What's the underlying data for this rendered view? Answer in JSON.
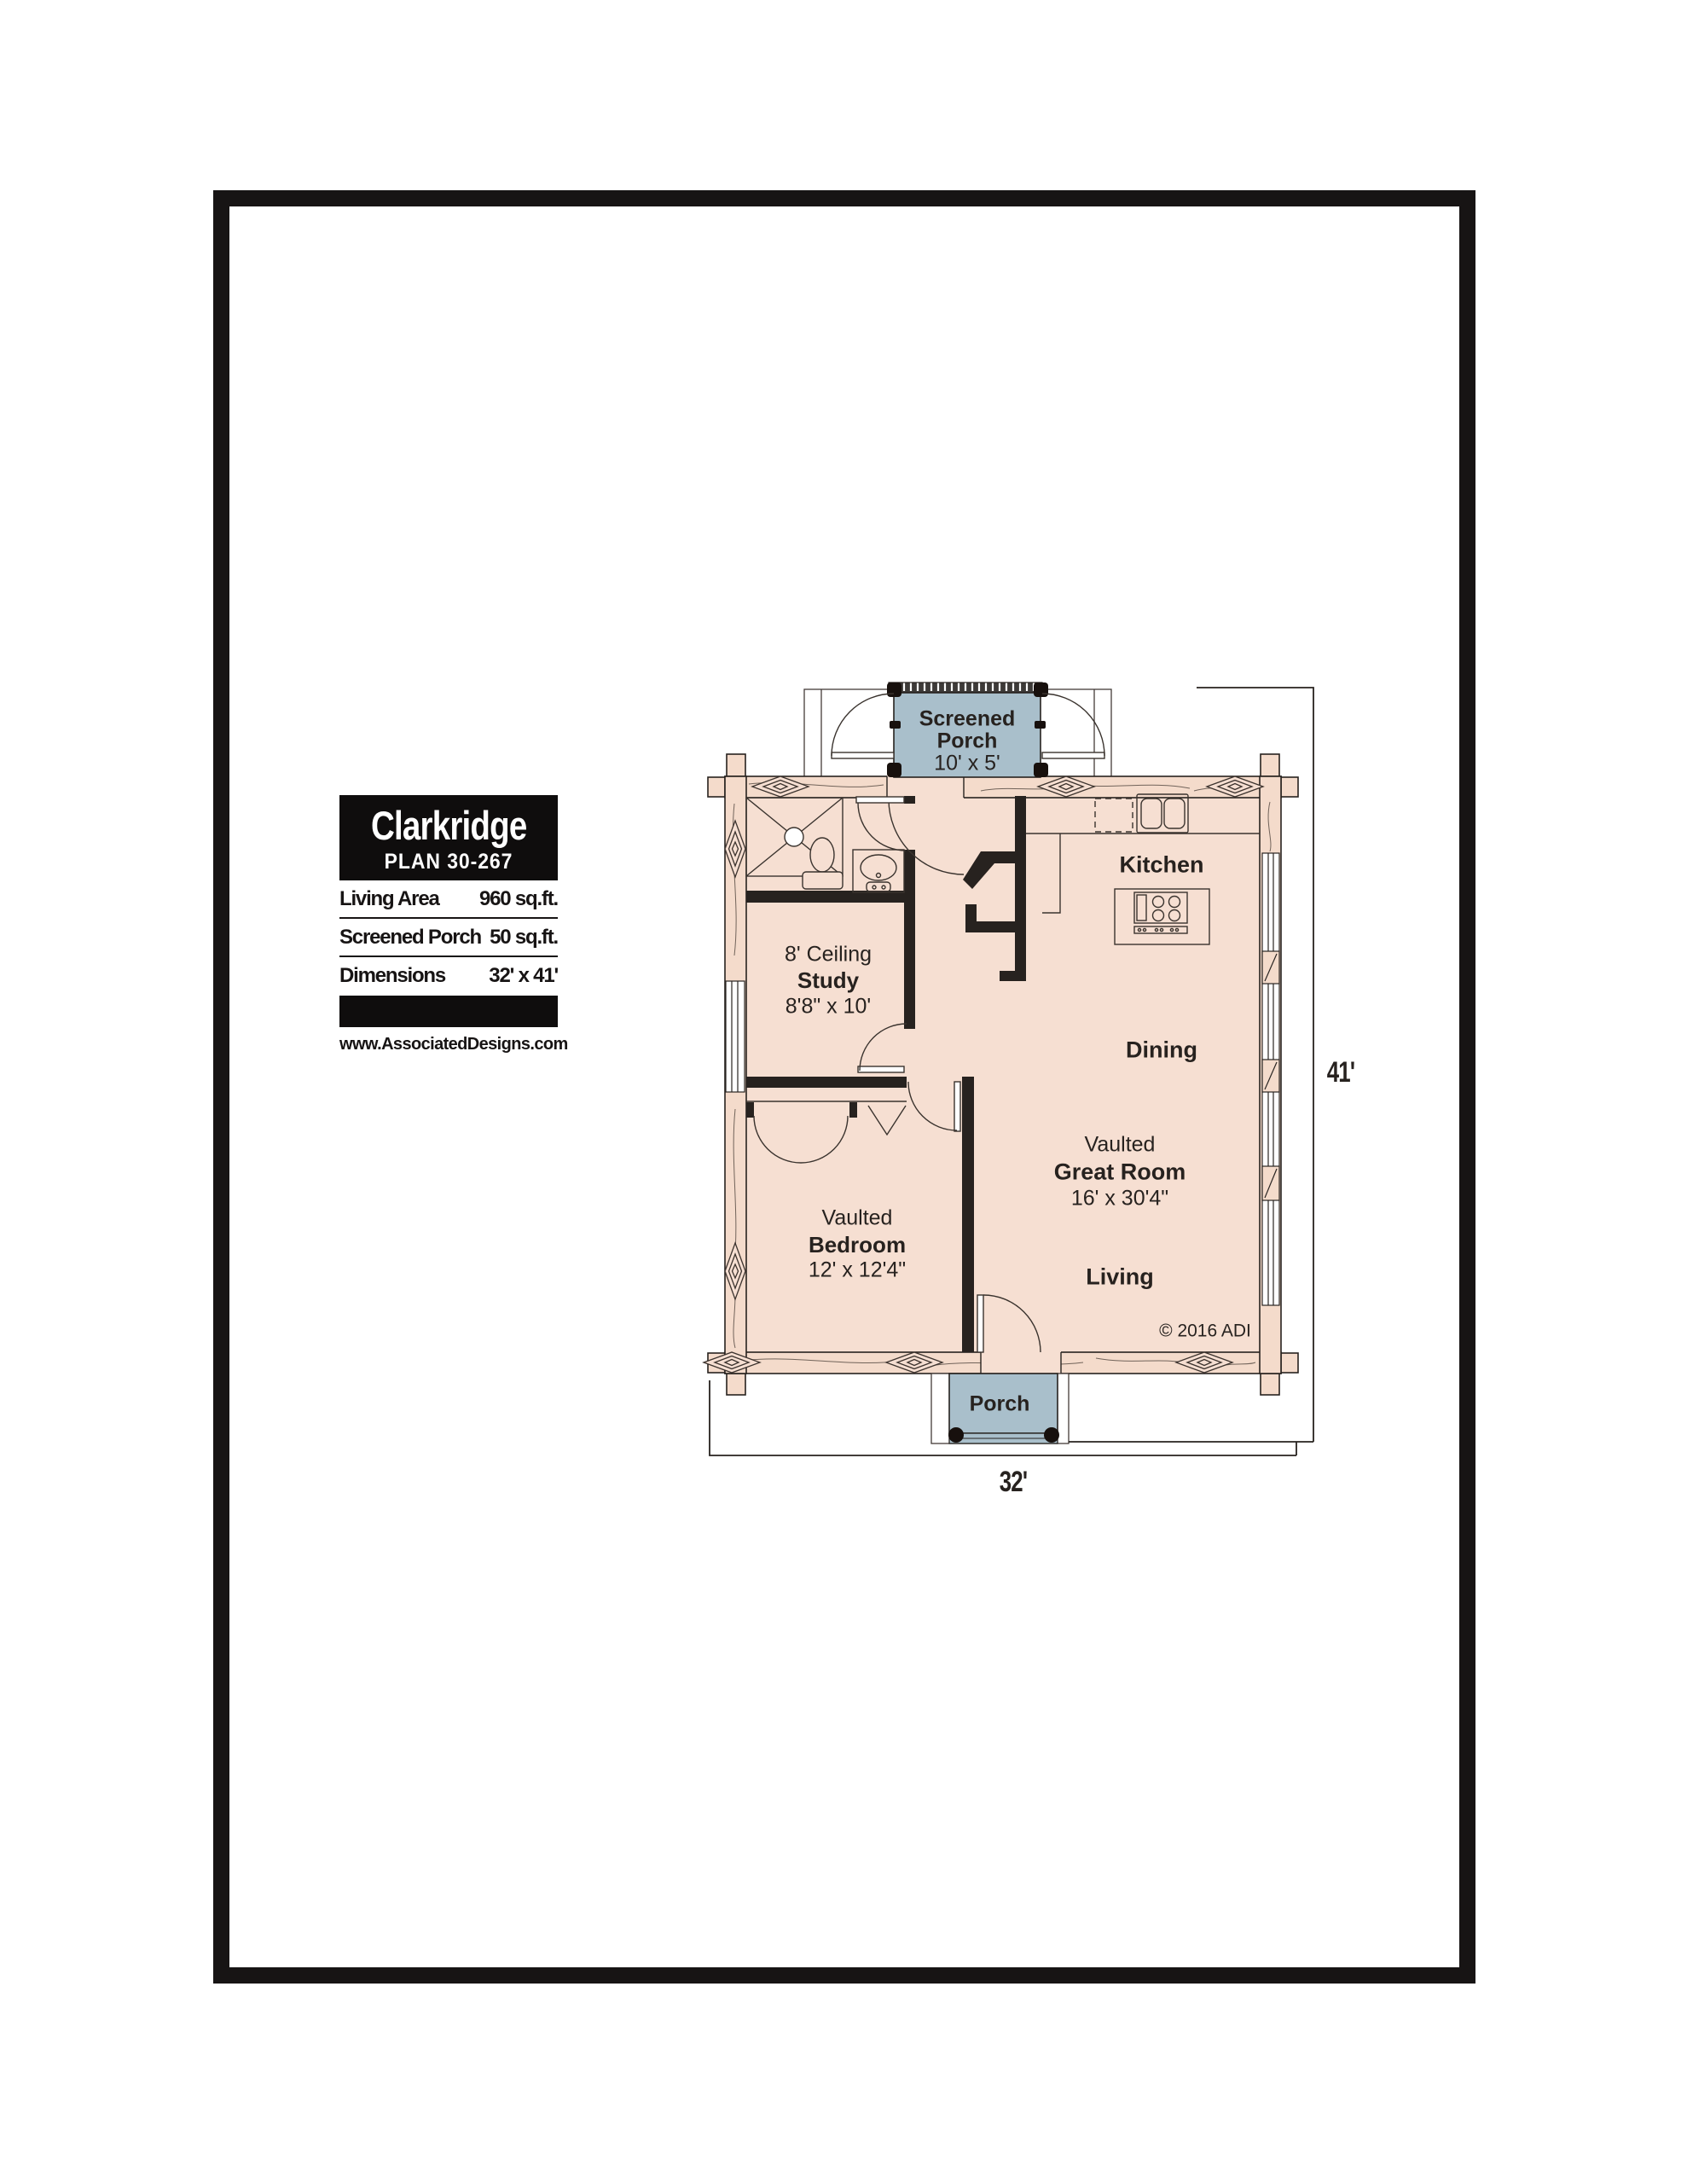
{
  "title_block": {
    "name": "Clarkridge",
    "plan": "PLAN 30-267",
    "rows": [
      {
        "label": "Living Area",
        "value": "960 sq.ft."
      },
      {
        "label": "Screened Porch",
        "value": "50 sq.ft."
      },
      {
        "label": "Dimensions",
        "value": "32' x 41'"
      }
    ],
    "website": "www.AssociatedDesigns.com"
  },
  "floor_plan": {
    "rooms": {
      "screened_porch": {
        "line1": "Screened",
        "line2": "Porch",
        "size": "10' x 5'"
      },
      "kitchen": {
        "name": "Kitchen"
      },
      "dining": {
        "name": "Dining"
      },
      "great_room": {
        "prefix": "Vaulted",
        "name": "Great Room",
        "size": "16' x 30'4\""
      },
      "living": {
        "name": "Living"
      },
      "study": {
        "prefix": "8' Ceiling",
        "name": "Study",
        "size": "8'8\" x 10'"
      },
      "bedroom": {
        "prefix": "Vaulted",
        "name": "Bedroom",
        "size": "12' x 12'4\""
      },
      "porch": {
        "name": "Porch"
      }
    },
    "dimensions": {
      "height": "41'",
      "width": "32'"
    },
    "copyright": "© 2016 ADI",
    "colors": {
      "floor": "#f6dfd2",
      "porch_blue": "#a9bfcb",
      "wall_line": "#27221f"
    }
  }
}
